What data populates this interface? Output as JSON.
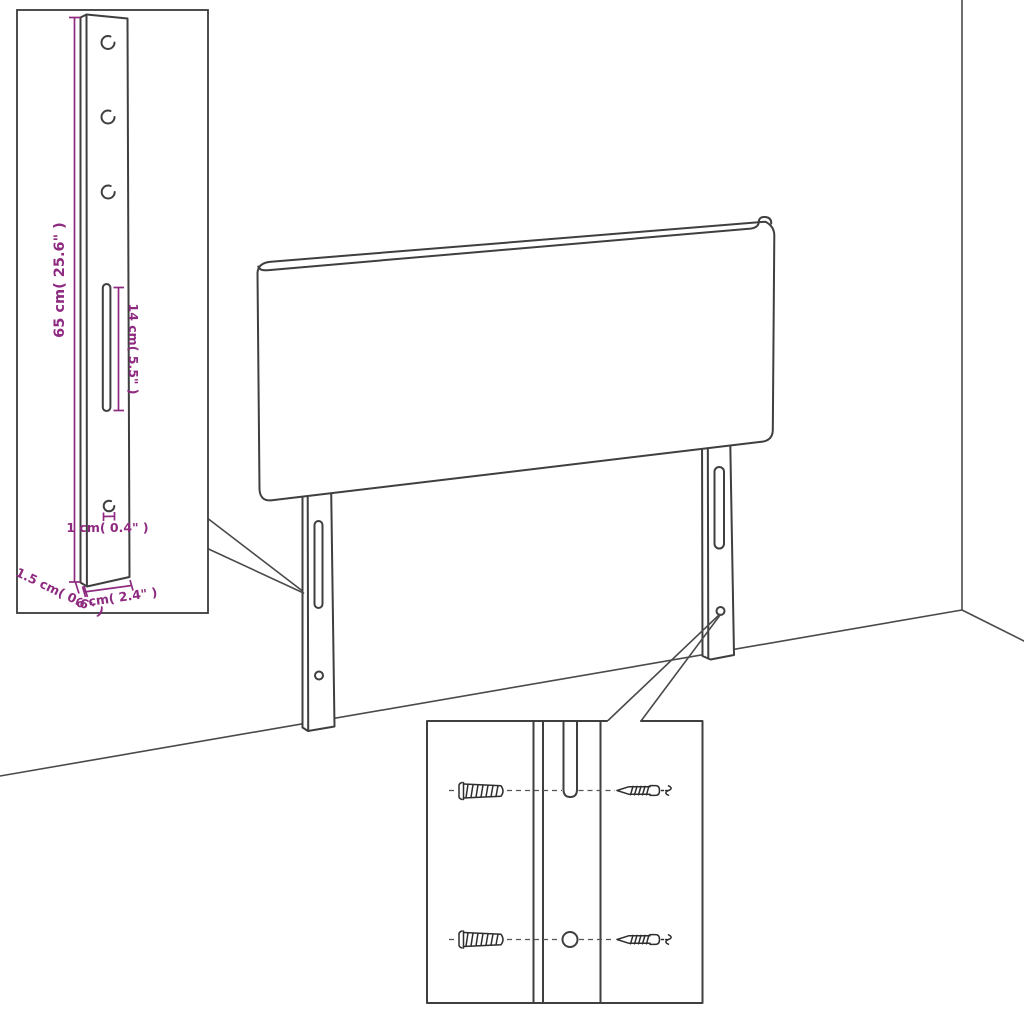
{
  "scene": {
    "type": "assembly-dimension-diagram",
    "subject": "upholstered headboard with two mounting legs standing against a wall corner",
    "colors": {
      "line": "#3f3f3f",
      "dimension_annotation": "#8e2a80",
      "background": "#ffffff"
    },
    "leg_detail_callout": {
      "dimensions": {
        "height": "65 cm( 25.6\" )",
        "slot_length": "14 cm( 5.5\" )",
        "hole_diameter": "1 cm( 0.4\" )",
        "width": "6 cm( 2.4\" )",
        "thickness": "1.5 cm( 0.6\" )"
      }
    },
    "mounting_detail_callout": {
      "icons": [
        "wall-plug-icon",
        "screw-icon",
        "mounting-hole-icon",
        "mounting-slot-icon"
      ]
    }
  }
}
